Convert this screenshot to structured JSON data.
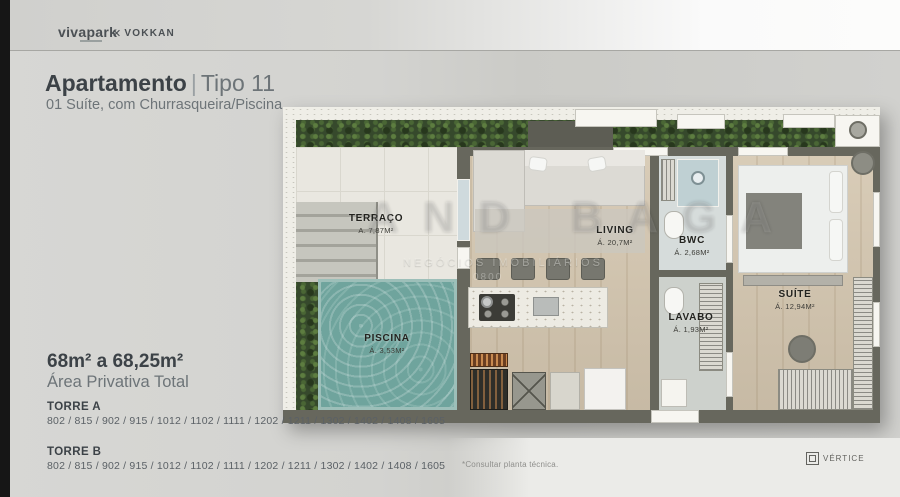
{
  "header": {
    "brand_primary": "vivapark",
    "brand_secondary": "VOKKAN",
    "brand_secondary_icon": "✕"
  },
  "title": {
    "main": "Apartamento",
    "separator": "|",
    "variant": "Tipo 11",
    "subtitle": "01 Suíte, com Churrasqueira/Piscina"
  },
  "plan": {
    "rooms": [
      {
        "id": "terraco",
        "name": "TERRAÇO",
        "area": "A. 7,87M²"
      },
      {
        "id": "piscina",
        "name": "PISCINA",
        "area": "Á. 3,53M²"
      },
      {
        "id": "living",
        "name": "LIVING",
        "area": "Á. 20,7M²"
      },
      {
        "id": "bwc",
        "name": "BWC",
        "area": "Á. 2,68M²"
      },
      {
        "id": "lavabo",
        "name": "LAVABO",
        "area": "Á. 1,93M²"
      },
      {
        "id": "suite",
        "name": "SUÍTE",
        "area": "Á. 12,94M²"
      }
    ]
  },
  "summary": {
    "area_range": "68m² a 68,25m²",
    "area_label": "Área Privativa Total"
  },
  "towers": [
    {
      "name": "TORRE A",
      "units": "802 / 815 / 902 / 915 / 1012 / 1102 / 1111 / 1202 / 1211 / 1302 / 1402 / 1408 / 1605"
    },
    {
      "name": "TORRE B",
      "units": "802 / 815 / 902 / 915 / 1012 / 1102 / 1111 / 1202 / 1211 / 1302 / 1402 / 1408 / 1605"
    }
  ],
  "footnote": {
    "text": "*Consultar planta técnica."
  },
  "credit": {
    "name": "VÉRTICE"
  },
  "watermark": {
    "line1": "AND BAGA",
    "line2": "NEGÓCIOS IMOBILIÁRIOS",
    "line3": "0800"
  },
  "colors": {
    "accent_wall": "#67675d",
    "pool": "#6fa49d",
    "plants": "#36492c",
    "text_dark": "#3c4247",
    "text_gray": "#6d7478"
  }
}
